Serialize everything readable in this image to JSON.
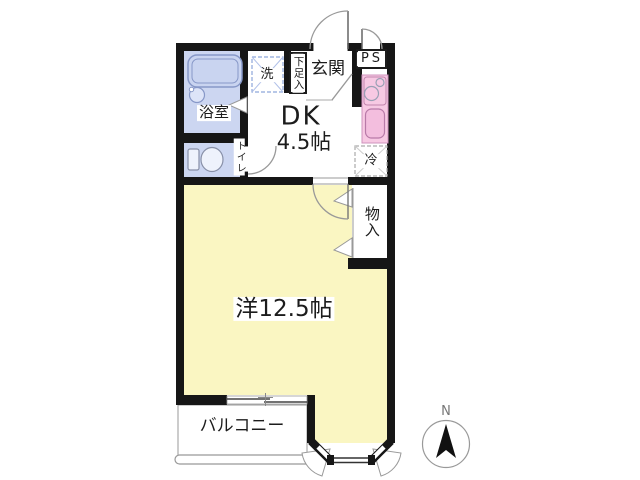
{
  "floorplan": {
    "labels": {
      "bathroom": "浴室",
      "laundry": "洗",
      "shoe_cabinet": "下足入",
      "entrance": "玄関",
      "pipe_space": "PS",
      "dk_line1": "DK",
      "dk_line2": "4.5帖",
      "refrigerator": "冷",
      "toilet": "トイレ",
      "closet": "物入",
      "western_room": "洋12.5帖",
      "balcony": "バルコニー",
      "compass_north": "N"
    },
    "colors": {
      "wall": "#161616",
      "room_yellow": "#FAF6C2",
      "bath_blue": "#CCD6F1",
      "kitchen_pink": "#F7C9E3"
    }
  }
}
